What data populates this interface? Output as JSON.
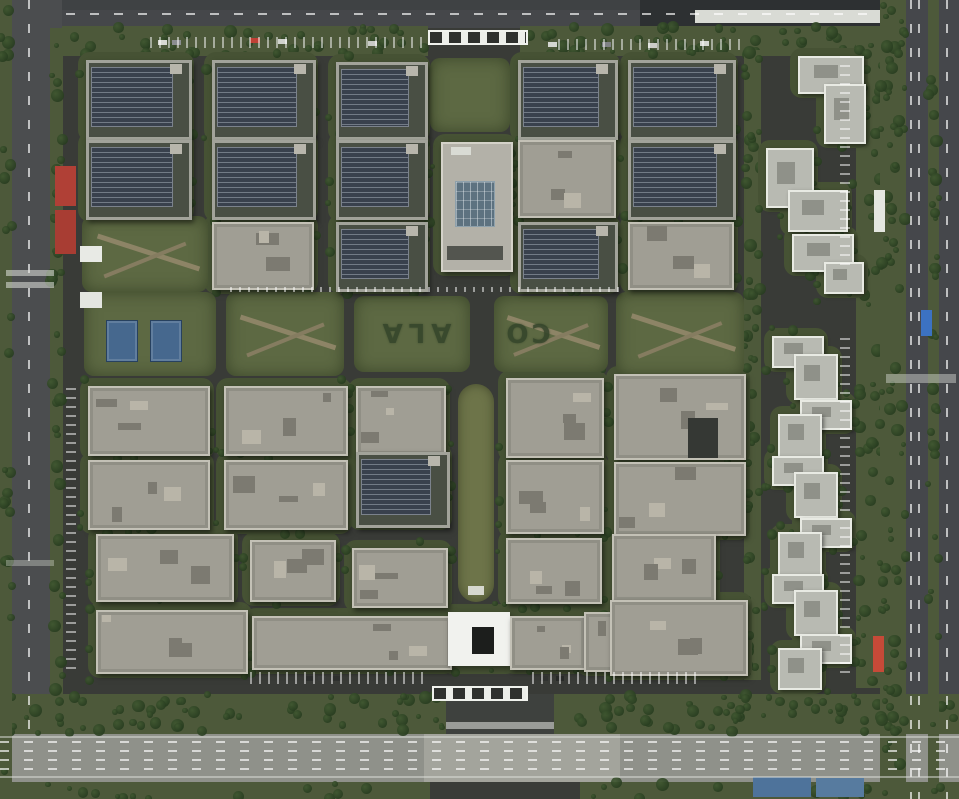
{
  "palette": {
    "asphalt": "#3a3c38",
    "grass": "#5d6943",
    "verge": "#4d593a",
    "pad": "#465234",
    "tree": "#273c1f",
    "median": "#6d7449",
    "solar": "#39414d",
    "concrete": "#a09e94",
    "tower": "#b8bab2",
    "highway": "#8f918a",
    "white": "#f1f2ee",
    "skylight": "#5d7280"
  },
  "lawn_text": {
    "left": "ALA",
    "right": "CO"
  },
  "roads": [
    {
      "x": 0,
      "y": 0,
      "w": 959,
      "h": 30,
      "c": "#45474a"
    },
    {
      "x": 0,
      "y": 0,
      "w": 640,
      "h": 10,
      "c": "#3f4244"
    },
    {
      "x": 640,
      "y": 0,
      "w": 319,
      "h": 28,
      "c": "#2d3032"
    },
    {
      "x": 695,
      "y": 10,
      "w": 264,
      "h": 13,
      "c": "#d9dbd5"
    },
    {
      "x": 0,
      "y": 0,
      "w": 62,
      "h": 799,
      "c": "#4b4d4f"
    },
    {
      "x": 884,
      "y": 0,
      "w": 75,
      "h": 799,
      "c": "#45474b"
    },
    {
      "x": 62,
      "y": 28,
      "w": 823,
      "h": 668,
      "c": "#393b37"
    },
    {
      "x": 0,
      "y": 730,
      "w": 959,
      "h": 52,
      "c": "#8f918a"
    },
    {
      "x": 424,
      "y": 730,
      "w": 196,
      "h": 52,
      "c": "#a3a49c"
    }
  ],
  "green_strips": [
    {
      "x": 62,
      "y": 26,
      "w": 366,
      "h": 30,
      "n": 46
    },
    {
      "x": 520,
      "y": 26,
      "w": 365,
      "h": 30,
      "n": 46
    },
    {
      "x": 0,
      "y": 694,
      "w": 446,
      "h": 40,
      "n": 62
    },
    {
      "x": 554,
      "y": 694,
      "w": 405,
      "h": 40,
      "n": 56
    },
    {
      "x": 0,
      "y": 0,
      "w": 12,
      "h": 799,
      "n": 25
    },
    {
      "x": 50,
      "y": 28,
      "w": 13,
      "h": 668,
      "n": 40
    },
    {
      "x": 744,
      "y": 50,
      "w": 17,
      "h": 630,
      "n": 45
    },
    {
      "x": 856,
      "y": 40,
      "w": 26,
      "h": 648,
      "n": 45
    },
    {
      "x": 880,
      "y": 0,
      "w": 26,
      "h": 799,
      "n": 85
    },
    {
      "x": 928,
      "y": 0,
      "w": 11,
      "h": 799,
      "n": 30
    },
    {
      "x": 0,
      "y": 782,
      "w": 430,
      "h": 17,
      "n": 14
    },
    {
      "x": 580,
      "y": 782,
      "w": 379,
      "h": 17,
      "n": 14
    }
  ],
  "lawns": [
    {
      "x": 84,
      "y": 292,
      "w": 132,
      "h": 84
    },
    {
      "x": 226,
      "y": 292,
      "w": 118,
      "h": 84,
      "paths": true
    },
    {
      "x": 354,
      "y": 296,
      "w": 116,
      "h": 76
    },
    {
      "x": 494,
      "y": 296,
      "w": 114,
      "h": 76,
      "paths": true
    },
    {
      "x": 616,
      "y": 292,
      "w": 128,
      "h": 84,
      "paths": true
    },
    {
      "x": 430,
      "y": 58,
      "w": 80,
      "h": 74
    },
    {
      "x": 82,
      "y": 216,
      "w": 126,
      "h": 76,
      "paths": true
    }
  ],
  "median": {
    "x": 458,
    "y": 384,
    "w": 36,
    "h": 218
  },
  "buildings": [
    {
      "x": 86,
      "y": 60,
      "w": 100,
      "h": 74,
      "t": "solar"
    },
    {
      "x": 212,
      "y": 60,
      "w": 98,
      "h": 74,
      "t": "solar"
    },
    {
      "x": 336,
      "y": 62,
      "w": 86,
      "h": 72,
      "t": "solar"
    },
    {
      "x": 518,
      "y": 60,
      "w": 94,
      "h": 74,
      "t": "solar"
    },
    {
      "x": 628,
      "y": 60,
      "w": 102,
      "h": 74,
      "t": "solar"
    },
    {
      "x": 86,
      "y": 140,
      "w": 100,
      "h": 74,
      "t": "solar"
    },
    {
      "x": 212,
      "y": 140,
      "w": 98,
      "h": 74,
      "t": "solar"
    },
    {
      "x": 336,
      "y": 140,
      "w": 86,
      "h": 74,
      "t": "solar"
    },
    {
      "x": 441,
      "y": 142,
      "w": 68,
      "h": 126,
      "t": "tower_center"
    },
    {
      "x": 518,
      "y": 140,
      "w": 94,
      "h": 74,
      "t": "concrete"
    },
    {
      "x": 628,
      "y": 140,
      "w": 102,
      "h": 74,
      "t": "solar"
    },
    {
      "x": 212,
      "y": 222,
      "w": 98,
      "h": 64,
      "t": "concrete"
    },
    {
      "x": 336,
      "y": 222,
      "w": 86,
      "h": 64,
      "t": "solar"
    },
    {
      "x": 518,
      "y": 222,
      "w": 94,
      "h": 64,
      "t": "solar"
    },
    {
      "x": 628,
      "y": 222,
      "w": 102,
      "h": 64,
      "t": "concrete"
    },
    {
      "x": 88,
      "y": 386,
      "w": 118,
      "h": 66,
      "t": "concrete"
    },
    {
      "x": 224,
      "y": 386,
      "w": 120,
      "h": 66,
      "t": "concrete"
    },
    {
      "x": 356,
      "y": 386,
      "w": 86,
      "h": 66,
      "t": "concrete"
    },
    {
      "x": 88,
      "y": 460,
      "w": 118,
      "h": 66,
      "t": "concrete"
    },
    {
      "x": 224,
      "y": 460,
      "w": 120,
      "h": 66,
      "t": "concrete"
    },
    {
      "x": 356,
      "y": 452,
      "w": 88,
      "h": 70,
      "t": "solar"
    },
    {
      "x": 96,
      "y": 534,
      "w": 134,
      "h": 64,
      "t": "concrete"
    },
    {
      "x": 250,
      "y": 540,
      "w": 82,
      "h": 58,
      "t": "concrete"
    },
    {
      "x": 352,
      "y": 548,
      "w": 92,
      "h": 56,
      "t": "concrete"
    },
    {
      "x": 96,
      "y": 610,
      "w": 148,
      "h": 60,
      "t": "concrete"
    },
    {
      "x": 252,
      "y": 616,
      "w": 196,
      "h": 50,
      "t": "concrete"
    },
    {
      "x": 448,
      "y": 612,
      "w": 62,
      "h": 54,
      "t": "white_center"
    },
    {
      "x": 510,
      "y": 616,
      "w": 72,
      "h": 50,
      "t": "concrete"
    },
    {
      "x": 584,
      "y": 612,
      "w": 96,
      "h": 56,
      "t": "concrete"
    },
    {
      "x": 506,
      "y": 378,
      "w": 94,
      "h": 76,
      "t": "concrete"
    },
    {
      "x": 614,
      "y": 374,
      "w": 128,
      "h": 82,
      "t": "concrete"
    },
    {
      "x": 506,
      "y": 460,
      "w": 94,
      "h": 70,
      "t": "concrete"
    },
    {
      "x": 614,
      "y": 462,
      "w": 128,
      "h": 70,
      "t": "concrete"
    },
    {
      "x": 506,
      "y": 538,
      "w": 92,
      "h": 62,
      "t": "concrete"
    },
    {
      "x": 612,
      "y": 534,
      "w": 100,
      "h": 64,
      "t": "concrete"
    },
    {
      "x": 610,
      "y": 600,
      "w": 134,
      "h": 72,
      "t": "concrete"
    }
  ],
  "towers": [
    {
      "x": 798,
      "y": 56,
      "w": 62,
      "h": 34
    },
    {
      "x": 824,
      "y": 84,
      "w": 38,
      "h": 56
    },
    {
      "x": 766,
      "y": 148,
      "w": 44,
      "h": 56
    },
    {
      "x": 788,
      "y": 190,
      "w": 56,
      "h": 38
    },
    {
      "x": 792,
      "y": 234,
      "w": 58,
      "h": 34
    },
    {
      "x": 824,
      "y": 262,
      "w": 36,
      "h": 28
    },
    {
      "x": 772,
      "y": 336,
      "w": 48,
      "h": 28
    },
    {
      "x": 794,
      "y": 354,
      "w": 40,
      "h": 42
    },
    {
      "x": 800,
      "y": 400,
      "w": 48,
      "h": 26
    },
    {
      "x": 778,
      "y": 414,
      "w": 40,
      "h": 40
    },
    {
      "x": 772,
      "y": 456,
      "w": 48,
      "h": 26
    },
    {
      "x": 794,
      "y": 472,
      "w": 40,
      "h": 42
    },
    {
      "x": 800,
      "y": 518,
      "w": 48,
      "h": 26
    },
    {
      "x": 778,
      "y": 532,
      "w": 40,
      "h": 40
    },
    {
      "x": 772,
      "y": 574,
      "w": 48,
      "h": 26
    },
    {
      "x": 794,
      "y": 590,
      "w": 40,
      "h": 42
    },
    {
      "x": 800,
      "y": 634,
      "w": 48,
      "h": 26
    },
    {
      "x": 778,
      "y": 648,
      "w": 40,
      "h": 38
    }
  ],
  "details": [
    {
      "n": "entrance-road",
      "x": 446,
      "y": 694,
      "w": 108,
      "h": 40,
      "c": "#3e413e"
    },
    {
      "n": "crosswalk",
      "x": 446,
      "y": 722,
      "w": 108,
      "h": 7,
      "c": "rgba(230,232,226,.55)"
    },
    {
      "n": "gate-north",
      "x": 428,
      "y": 30,
      "w": 96,
      "h": 11,
      "cls": "gate"
    },
    {
      "n": "gate-south",
      "x": 432,
      "y": 686,
      "w": 92,
      "h": 11,
      "cls": "gate"
    },
    {
      "n": "guard-booth",
      "x": 80,
      "y": 246,
      "w": 22,
      "h": 16,
      "c": "#e8eae5"
    },
    {
      "n": "guard-booth",
      "x": 80,
      "y": 292,
      "w": 22,
      "h": 16,
      "c": "#e3e5e0"
    },
    {
      "n": "canopy-blue",
      "x": 106,
      "y": 320,
      "w": 30,
      "h": 40,
      "c": "#46688e",
      "cls": "canopy"
    },
    {
      "n": "canopy-blue",
      "x": 150,
      "y": 320,
      "w": 30,
      "h": 40,
      "c": "#46688e",
      "cls": "canopy"
    },
    {
      "n": "container-red",
      "x": 55,
      "y": 166,
      "w": 21,
      "h": 40,
      "c": "#b04036"
    },
    {
      "n": "container-red",
      "x": 55,
      "y": 210,
      "w": 21,
      "h": 44,
      "c": "#a83d33"
    },
    {
      "n": "container-red",
      "x": 873,
      "y": 636,
      "w": 11,
      "h": 36,
      "c": "#c64a38"
    },
    {
      "n": "truck-blue",
      "x": 921,
      "y": 310,
      "w": 11,
      "h": 26,
      "c": "#3c72c2"
    },
    {
      "n": "structure-white",
      "x": 874,
      "y": 190,
      "w": 11,
      "h": 42,
      "c": "#e4e6e0"
    },
    {
      "n": "tarp-blue",
      "x": 753,
      "y": 777,
      "w": 58,
      "h": 20,
      "c": "#4e739b"
    },
    {
      "n": "tarp-blue",
      "x": 816,
      "y": 778,
      "w": 48,
      "h": 19,
      "c": "#577b9f"
    },
    {
      "n": "roof-notch",
      "x": 688,
      "y": 418,
      "w": 30,
      "h": 40,
      "c": "#353834"
    },
    {
      "n": "median-cap",
      "x": 468,
      "y": 586,
      "w": 16,
      "h": 9,
      "c": "#d6d8cf"
    },
    {
      "n": "car",
      "x": 158,
      "y": 40,
      "w": 9,
      "h": 5,
      "c": "#d8d8d3"
    },
    {
      "n": "car",
      "x": 172,
      "y": 40,
      "w": 9,
      "h": 5,
      "c": "#8a8d90"
    },
    {
      "n": "car",
      "x": 250,
      "y": 38,
      "w": 10,
      "h": 5,
      "c": "#c04035"
    },
    {
      "n": "car",
      "x": 278,
      "y": 39,
      "w": 9,
      "h": 5,
      "c": "#d0d2cd"
    },
    {
      "n": "car",
      "x": 368,
      "y": 41,
      "w": 9,
      "h": 5,
      "c": "#c8cac6"
    },
    {
      "n": "car",
      "x": 548,
      "y": 42,
      "w": 9,
      "h": 5,
      "c": "#d4d6d1"
    },
    {
      "n": "car",
      "x": 602,
      "y": 42,
      "w": 9,
      "h": 5,
      "c": "#7e8184"
    },
    {
      "n": "car",
      "x": 648,
      "y": 43,
      "w": 9,
      "h": 5,
      "c": "#cbccc7"
    },
    {
      "n": "car",
      "x": 700,
      "y": 41,
      "w": 9,
      "h": 5,
      "c": "#d5d7d2"
    },
    {
      "n": "car",
      "x": 306,
      "y": 676,
      "w": 8,
      "h": 5,
      "c": "#2c2e2c"
    },
    {
      "n": "car",
      "x": 318,
      "y": 676,
      "w": 8,
      "h": 5,
      "c": "#3a3c3a"
    },
    {
      "n": "car",
      "x": 332,
      "y": 676,
      "w": 8,
      "h": 5,
      "c": "#2d2f2d"
    },
    {
      "n": "car",
      "x": 540,
      "y": 676,
      "w": 8,
      "h": 5,
      "c": "#303230"
    },
    {
      "n": "car",
      "x": 556,
      "y": 676,
      "w": 8,
      "h": 5,
      "c": "#272927"
    }
  ],
  "markings": [
    {
      "x": 66,
      "y": 13,
      "w": 816,
      "h": 2,
      "cls": "dash-h"
    },
    {
      "x": 28,
      "y": 0,
      "w": 2,
      "h": 730,
      "cls": "dash-v"
    },
    {
      "x": 910,
      "y": 0,
      "w": 2,
      "h": 799,
      "cls": "dash-v"
    },
    {
      "x": 918,
      "y": 0,
      "w": 2,
      "h": 799,
      "cls": "dash-v"
    },
    {
      "x": 946,
      "y": 0,
      "w": 2,
      "h": 799,
      "cls": "dash-v"
    },
    {
      "x": 0,
      "y": 741,
      "w": 959,
      "h": 2,
      "cls": "dash-h"
    },
    {
      "x": 0,
      "y": 750,
      "w": 959,
      "h": 2,
      "cls": "dash-h"
    },
    {
      "x": 0,
      "y": 759,
      "w": 959,
      "h": 2,
      "cls": "dash-h"
    },
    {
      "x": 0,
      "y": 768,
      "w": 959,
      "h": 2,
      "cls": "dash-h"
    },
    {
      "x": 0,
      "y": 736,
      "w": 959,
      "h": 2,
      "c": "rgba(222,224,218,.5)"
    },
    {
      "x": 0,
      "y": 776,
      "w": 959,
      "h": 2,
      "c": "rgba(222,224,218,.5)"
    },
    {
      "x": 6,
      "y": 270,
      "w": 48,
      "h": 6,
      "c": "rgba(226,228,222,.55)"
    },
    {
      "x": 6,
      "y": 282,
      "w": 48,
      "h": 6,
      "c": "rgba(226,228,222,.55)"
    },
    {
      "x": 6,
      "y": 560,
      "w": 48,
      "h": 6,
      "c": "rgba(226,228,222,.35)"
    },
    {
      "x": 886,
      "y": 374,
      "w": 70,
      "h": 9,
      "c": "rgba(218,220,214,.45)"
    },
    {
      "x": 840,
      "y": 56,
      "w": 10,
      "h": 212,
      "cls": "ticks-v"
    },
    {
      "x": 840,
      "y": 338,
      "w": 10,
      "h": 336,
      "cls": "ticks-v"
    },
    {
      "x": 66,
      "y": 388,
      "w": 10,
      "h": 282,
      "cls": "ticks-v"
    },
    {
      "x": 250,
      "y": 672,
      "w": 180,
      "h": 12,
      "cls": "ticks-h"
    },
    {
      "x": 532,
      "y": 672,
      "w": 168,
      "h": 12,
      "cls": "ticks-h"
    },
    {
      "x": 150,
      "y": 37,
      "w": 272,
      "h": 11,
      "cls": "ticks-h"
    },
    {
      "x": 558,
      "y": 39,
      "w": 186,
      "h": 11,
      "cls": "ticks-h"
    },
    {
      "x": 230,
      "y": 287,
      "w": 390,
      "h": 5,
      "cls": "ticks-h"
    }
  ]
}
